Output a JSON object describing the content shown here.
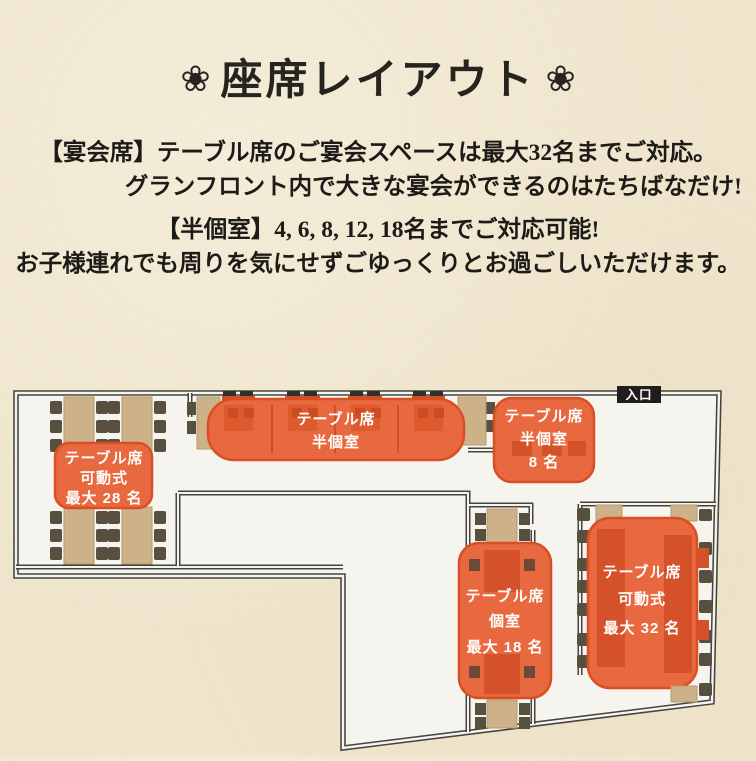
{
  "title": {
    "flower": "❀",
    "text": "座席レイアウト"
  },
  "intro": {
    "line1": "【宴会席】テーブル席のご宴会スペースは最大32名までご対応。",
    "line2": "グランフロント内で大きな宴会ができるのはたちばなだけ!",
    "line3": "【半個室】4, 6, 8, 12, 18名までご対応可能!",
    "line4": "お子様連れでも周りを気にせずごゆっくりとお過ごしいただけます。"
  },
  "floorplan": {
    "entrance": "入口",
    "areas": {
      "movable28": {
        "lines": [
          "テーブル席",
          "可動式",
          "最大 28 名"
        ]
      },
      "semiPrivateMain": {
        "lines": [
          "テーブル席",
          "半個室"
        ]
      },
      "semiPrivate8": {
        "lines": [
          "テーブル席",
          "半個室",
          "8 名"
        ]
      },
      "private18": {
        "lines": [
          "テーブル席",
          "個室",
          "最大 18 名"
        ]
      },
      "movable32": {
        "lines": [
          "テーブル席",
          "可動式",
          "最大 32 名"
        ]
      }
    },
    "colors": {
      "area_fill": "#e8693f",
      "area_border": "#d94e23",
      "table_tan": "#cdb188",
      "table_red": "#cf4f27",
      "chair_dark": "#57503f",
      "wall": "#45433e",
      "floor": "#f5f4ef",
      "entrance_bg": "#1f1e1b"
    }
  }
}
